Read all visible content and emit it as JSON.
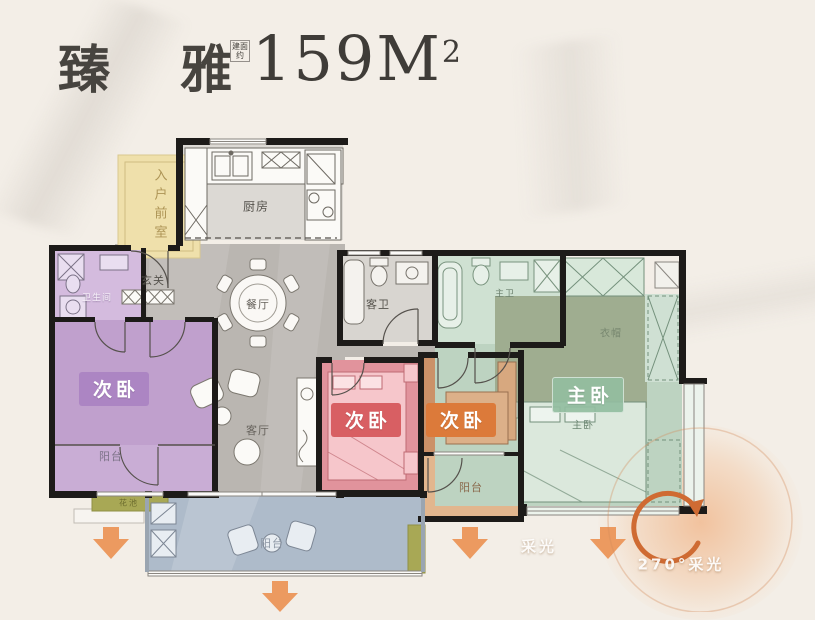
{
  "title": {
    "name": "臻 雅",
    "area_note": "建面约",
    "area": "159M",
    "area_sup": "2"
  },
  "rooms": {
    "entry_room": {
      "label": "入户前室"
    },
    "kitchen": {
      "label": "厨房"
    },
    "foyer": {
      "label": "玄关"
    },
    "dining": {
      "label": "餐厅"
    },
    "living": {
      "label": "客厅"
    },
    "bath_left": {
      "label": "卫生间"
    },
    "bedroom_left": {
      "label": "次卧"
    },
    "balcony_left": {
      "label": "阳台"
    },
    "planter_left": {
      "label": "花池"
    },
    "guest_bath": {
      "label": "客卫"
    },
    "bedroom_mid": {
      "label": "次卧"
    },
    "bedroom_right": {
      "label": "次卧"
    },
    "balcony_right": {
      "label": "阳台"
    },
    "master_bath": {
      "label": "主卫"
    },
    "cloakroom": {
      "label": "衣帽"
    },
    "master_bedroom": {
      "label": "主卧"
    },
    "master_bed": {
      "label": "主卧"
    },
    "balcony_main": {
      "label": "阳台"
    }
  },
  "annotations": {
    "daylight": "采光",
    "daylight_270": "270°采光"
  },
  "colors": {
    "background": "#f3eee7",
    "wall": "#1d1b19",
    "floor_marble": "#bab6b1",
    "entry_yellow": "#efe0ab",
    "purple_room": "#c0a0cd",
    "pink_room": "#e1939c",
    "pink_badge": "#d85f63",
    "orange_room": "#cb9168",
    "orange_badge": "#dc7a3a",
    "green_room": "#bdd3c1",
    "green_badge": "#93bd9f",
    "purple_badge": "#aa82c2",
    "balcony_blue": "#aebbca",
    "arrow_orange": "#ec9a60",
    "glow_orange": "#eda06a"
  }
}
